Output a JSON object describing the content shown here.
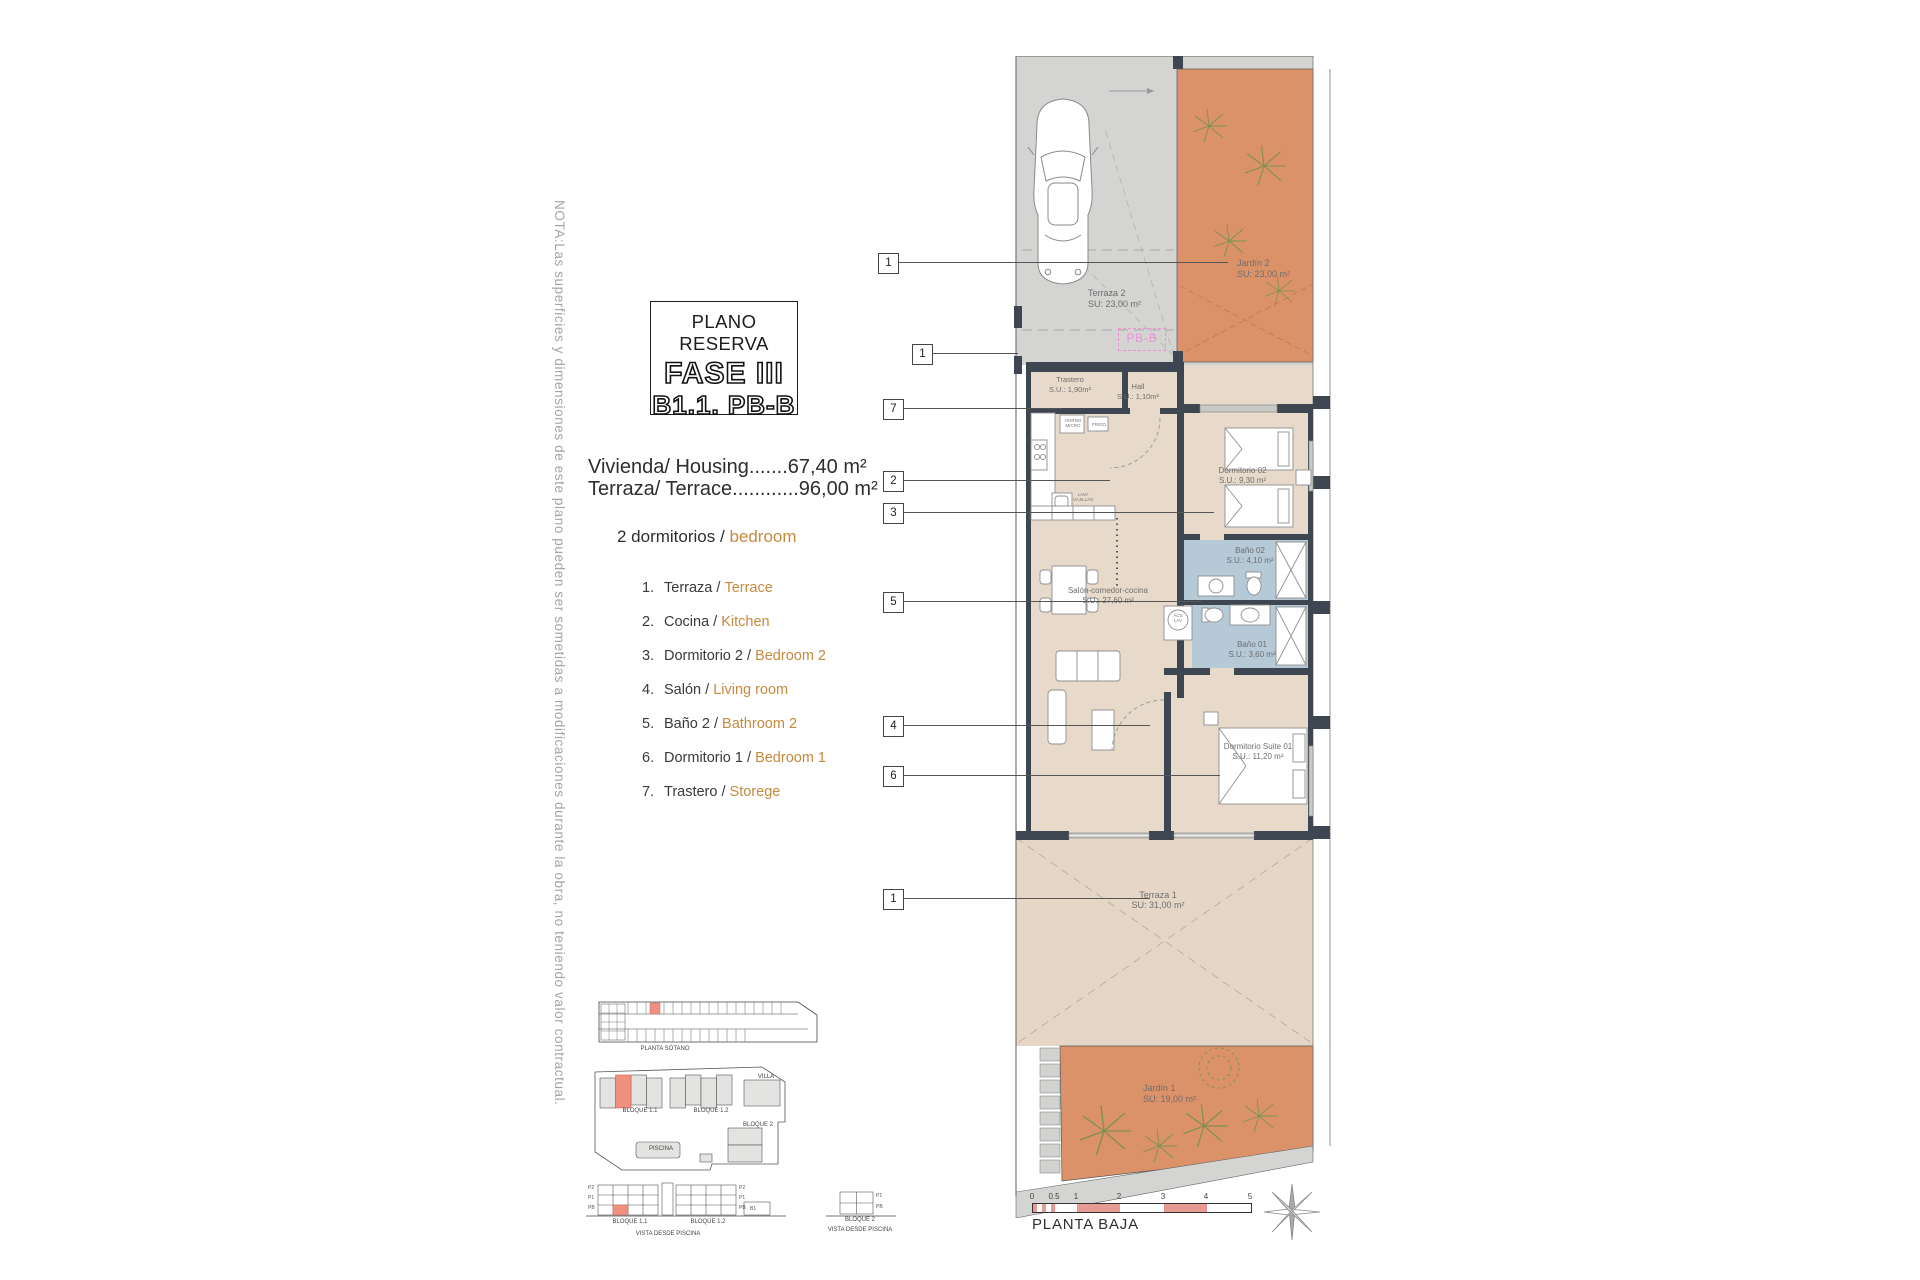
{
  "note": "NOTA:Las superficies y dimensiones de este plano pueden ser sometidas a modificaciones durante la obra, no teniendo valor contractual.",
  "title_block": {
    "subtitle": "PLANO RESERVA",
    "phase": "FASE III",
    "unit": "B1.1. PB-B"
  },
  "summary": {
    "housing": "Vivienda/ Housing.......67,40 m²",
    "terrace": "Terraza/ Terrace............96,00 m²",
    "bedrooms_es": "2 dormitorios /",
    "bedrooms_en": "bedroom"
  },
  "legend": {
    "items": [
      {
        "num": "1.",
        "es": "Terraza /",
        "en": "Terrace"
      },
      {
        "num": "2.",
        "es": "Cocina /",
        "en": "Kitchen"
      },
      {
        "num": "3.",
        "es": "Dormitorio 2 /",
        "en": "Bedroom 2"
      },
      {
        "num": "4.",
        "es": "Salón /",
        "en": "Living room"
      },
      {
        "num": "5.",
        "es": "Baño 2 /",
        "en": "Bathroom 2"
      },
      {
        "num": "6.",
        "es": "Dormitorio 1 /",
        "en": "Bedroom 1"
      },
      {
        "num": "7.",
        "es": "Trastero /",
        "en": "Storege"
      }
    ]
  },
  "plan": {
    "unit_tag": "PB-B",
    "callouts": [
      "1",
      "1",
      "7",
      "2",
      "3",
      "5",
      "4",
      "6",
      "1"
    ],
    "rooms": {
      "terraza2": {
        "name": "Terraza 2",
        "area": "SU: 23,00 m²"
      },
      "jardin2": {
        "name": "Jardín 2",
        "area": "SU: 23,00 m²"
      },
      "trastero": {
        "name": "Trastero",
        "area": "S.U.: 1,90m²"
      },
      "hall": {
        "name": "Hall",
        "area": "S.U.: 1,10m²"
      },
      "dormitorio02": {
        "name": "Dormitorio 02",
        "area": "S.U.: 9,30 m²"
      },
      "bano02": {
        "name": "Baño 02",
        "area": "S.U.: 4,10 m²"
      },
      "salon": {
        "name": "Salón-comedor-cocina",
        "area": "S.U.: 27,60 m²"
      },
      "bano01": {
        "name": "Baño 01",
        "area": "S.U.: 3,60 m²"
      },
      "suite": {
        "name": "Dormitorio Suite 01",
        "area": "S.U.: 11,20 m²"
      },
      "terraza1": {
        "name": "Terraza 1",
        "area": "SU: 31,00 m²"
      },
      "jardin1": {
        "name": "Jardín 1",
        "area": "SU: 19,00 m²"
      }
    },
    "fixtures": {
      "horno": "HORNO",
      "micro": "MICRO",
      "frigo": "FRIGO",
      "lava": "LAVA",
      "vajillas": "VAJILLAS",
      "acs": "ACS",
      "lav": "LAV"
    },
    "scale": {
      "ticks": [
        "0",
        "0.5",
        "1",
        "2",
        "3",
        "4",
        "5"
      ],
      "caption": "PLANTA BAJA"
    }
  },
  "minimap": {
    "sotano": "PLANTA SÓTANO",
    "bloque11": "BLOQUE 1.1",
    "bloque12": "BLOQUE 1.2",
    "bloque2": "BLOQUE 2",
    "villa": "VILLA",
    "piscina": "PISCINA",
    "b1": "B1",
    "vista": "VISTA DESDE PISCINA",
    "floors": [
      "P2",
      "P1",
      "PB"
    ],
    "floors_b2": [
      "P1",
      "PB"
    ]
  },
  "colors": {
    "garden": "#DC9268",
    "paving": "#D4D4D2",
    "floor": "#E8DACA",
    "terrace": "#E5D6C5",
    "bath": "#B5C9D7",
    "wall": "#3E4651",
    "accent_text": "#C68A3D",
    "highlight": "#F0907F",
    "tag_pink": "#F08FD8",
    "scale_pink": "#E79B94"
  }
}
